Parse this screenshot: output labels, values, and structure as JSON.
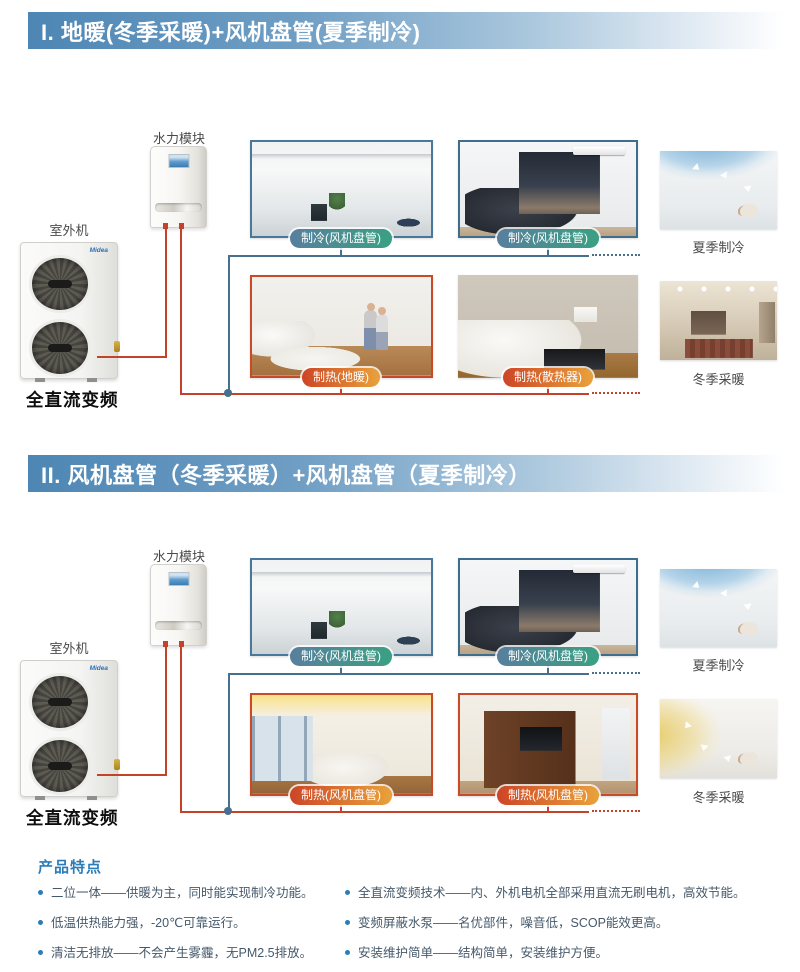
{
  "sections": [
    {
      "header": "I. 地暖(冬季采暖)+风机盘管(夏季制冷)",
      "hydraulic_module_label": "水力模块",
      "outdoor_unit_label": "室外机",
      "outdoor_unit_caption": "全直流变频",
      "brand": "Midea",
      "room_labels": {
        "top_left": "制冷(风机盘管)",
        "top_right": "制冷(风机盘管)",
        "bottom_left": "制热(地暖)",
        "bottom_right": "制热(散热器)"
      },
      "side_captions": {
        "top": "夏季制冷",
        "bottom": "冬季采暖"
      }
    },
    {
      "header": "II. 风机盘管（冬季采暖）+风机盘管（夏季制冷）",
      "hydraulic_module_label": "水力模块",
      "outdoor_unit_label": "室外机",
      "outdoor_unit_caption": "全直流变频",
      "brand": "Midea",
      "room_labels": {
        "top_left": "制冷(风机盘管)",
        "top_right": "制冷(风机盘管)",
        "bottom_left": "制热(风机盘管)",
        "bottom_right": "制热(风机盘管)"
      },
      "side_captions": {
        "top": "夏季制冷",
        "bottom": "冬季采暖"
      }
    }
  ],
  "features": {
    "title": "产品特点",
    "columns": [
      {
        "items": [
          "二位一体——供暖为主，同时能实现制冷功能。",
          "低温供热能力强，-20℃可靠运行。",
          "清洁无排放——不会产生雾霾，无PM2.5排放。"
        ]
      },
      {
        "items": [
          "全直流变频技术——内、外机电机全部采用直流无刷电机，高效节能。",
          "变频屏蔽水泵——名优部件，噪音低，SCOP能效更高。",
          "安装维护简单——结构简单，安装维护方便。"
        ]
      }
    ]
  },
  "colors": {
    "header_bar_blue": "#4d86b4",
    "cooling_label_blue": "#587f9d",
    "cooling_label_green": "#3aa083",
    "heating_label_red": "#cd4526",
    "heating_label_orange": "#e9a23b",
    "cooling_pipe": "#46708e",
    "heating_pipe": "#c4412a",
    "features_blue": "#2b7cb8"
  }
}
